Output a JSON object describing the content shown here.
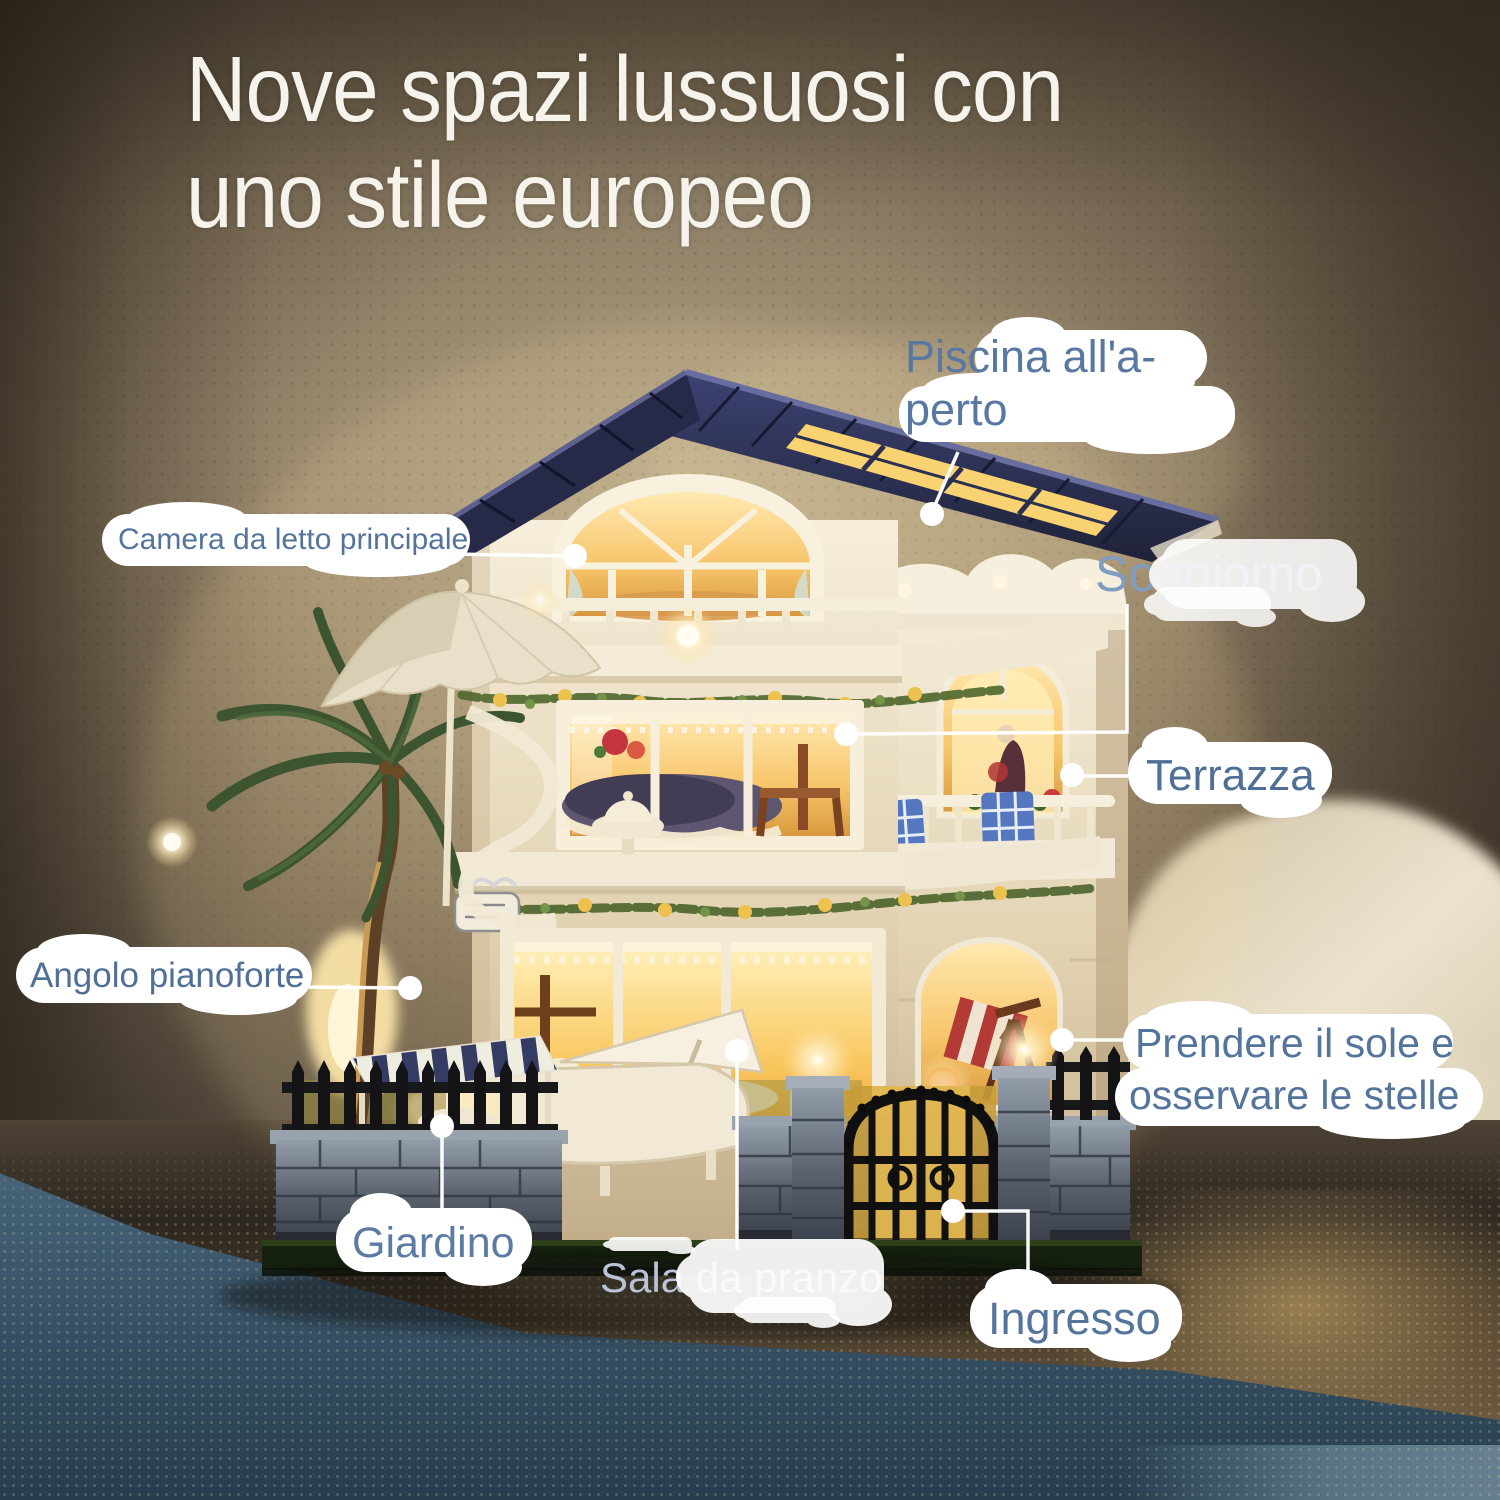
{
  "title": {
    "line1": "Nove spazi lussuosi con",
    "line2": "uno stile europeo"
  },
  "labels": {
    "pool": {
      "line1": "Piscina all'a-",
      "line2": "perto"
    },
    "master_bedroom": {
      "text": "Camera da letto principale"
    },
    "living_room": {
      "text": "Soggiorno"
    },
    "terrace": {
      "text": "Terrazza"
    },
    "piano_corner": {
      "text": "Angolo pianoforte"
    },
    "sunbathing": {
      "line1": "Prendere il sole e",
      "line2": "osservare le stelle"
    },
    "garden": {
      "text": "Giardino"
    },
    "dining_room": {
      "part1": "Sala da ",
      "part2": "pranzo"
    },
    "entrance": {
      "text": "Ingresso"
    }
  },
  "colors": {
    "label_text": "#54749c",
    "label_text_light": "#b9c3d6",
    "title_text": "#f6f3ec",
    "highlight": "#ffffff",
    "roof_navy": "#2c2f4d",
    "window_glow": "#f6c468",
    "leader_line": "#ffffff"
  }
}
